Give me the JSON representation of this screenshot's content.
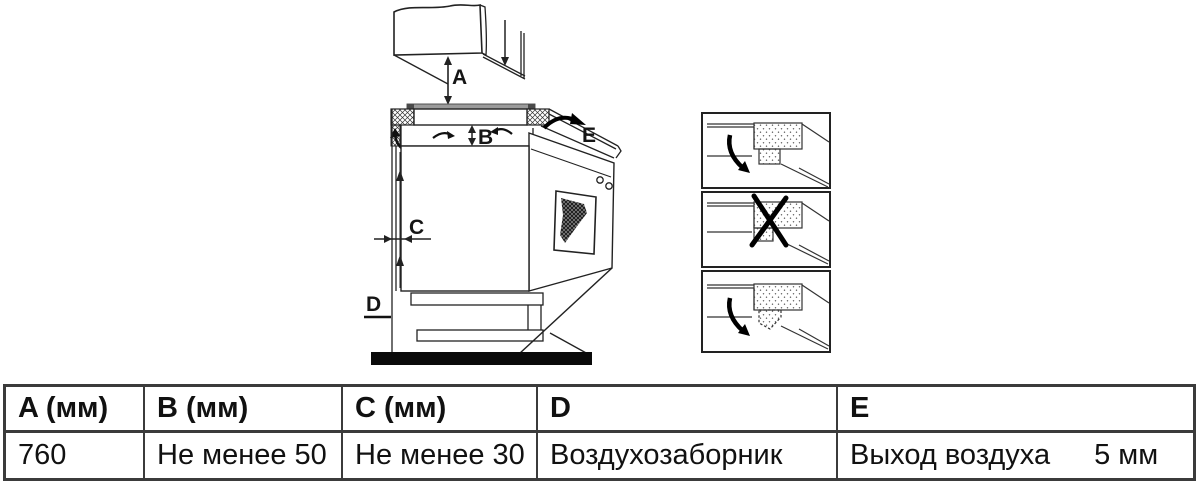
{
  "diagram": {
    "labels": {
      "a": "A",
      "b": "B",
      "c": "C",
      "d": "D",
      "e": "E"
    },
    "colors": {
      "line": "#222222",
      "hob_surface_band": "#9b9b9b",
      "floor": "#0a0a0a",
      "table_border": "#3b3b3b"
    }
  },
  "detail_panels": [
    {
      "name": "hob-edge-with-gap",
      "status": "correct"
    },
    {
      "name": "hob-edge-flush",
      "status": "incorrect-crossed-out"
    },
    {
      "name": "hob-edge-chamfered",
      "status": "correct"
    }
  ],
  "table": {
    "headers": [
      "A (мм)",
      "B (мм)",
      "C (мм)",
      "D",
      "E"
    ],
    "row": {
      "a": "760",
      "b": "Не менее 50",
      "c": "Не менее 30",
      "d": "Воздухозаборник",
      "e_text": "Выход воздуха",
      "e_value": "5 мм"
    }
  }
}
